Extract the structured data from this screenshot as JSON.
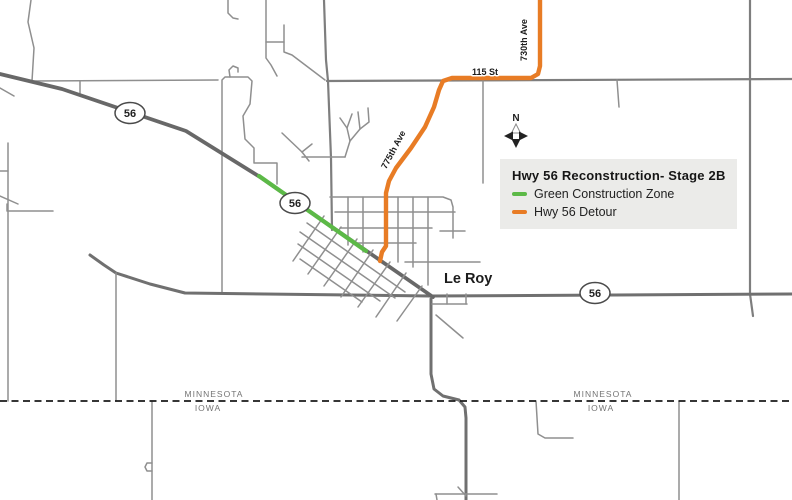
{
  "legend": {
    "title": "Hwy 56 Reconstruction- Stage 2B",
    "items": [
      {
        "label": "Green Construction Zone",
        "color": "#5cb947"
      },
      {
        "label": "Hwy 56 Detour",
        "color": "#e87c25"
      }
    ]
  },
  "map_labels": {
    "town": "Le Roy",
    "road_730": "730th Ave",
    "road_115": "115 St",
    "road_775": "775th Ave",
    "minnesota": "MINNESOTA",
    "iowa": "IOWA",
    "north": "N"
  },
  "shield": {
    "label": "56"
  },
  "colors": {
    "construction_green": "#5cb947",
    "detour_orange": "#e87c25",
    "legend_background": "#ebebe9",
    "state_border": "#1a1a1a"
  },
  "map": {
    "width": 792,
    "height": 500,
    "road_styles": {
      "minor": {
        "color": "#8f8f8f",
        "width": 1.5
      },
      "major": {
        "color": "#7e7e7e",
        "width": 2.2
      },
      "trunk": {
        "color": "#707070",
        "width": 3
      },
      "highway": {
        "color": "#686868",
        "width": 3.8
      },
      "construction": {
        "color": "#5cb947",
        "width": 4.2
      },
      "detour": {
        "color": "#e87c25",
        "width": 4.4
      },
      "border": {
        "color": "#1a1a1a",
        "width": 1.8,
        "dash": "7 4.5"
      }
    },
    "roads": [
      {
        "type": "minor",
        "pts": [
          [
            31,
            0
          ],
          [
            28,
            22
          ],
          [
            34,
            48
          ],
          [
            32,
            81
          ]
        ]
      },
      {
        "type": "minor",
        "pts": [
          [
            33,
            81
          ],
          [
            218,
            80
          ]
        ]
      },
      {
        "type": "minor",
        "pts": [
          [
            80,
            81
          ],
          [
            80,
            93
          ]
        ]
      },
      {
        "type": "minor",
        "pts": [
          [
            0,
            88
          ],
          [
            14,
            96
          ]
        ]
      },
      {
        "type": "minor",
        "pts": [
          [
            8,
            143
          ],
          [
            8,
            401
          ]
        ]
      },
      {
        "type": "minor",
        "pts": [
          [
            0,
            171
          ],
          [
            8,
            171
          ]
        ]
      },
      {
        "type": "minor",
        "pts": [
          [
            0,
            196
          ],
          [
            18,
            204
          ]
        ]
      },
      {
        "type": "minor",
        "pts": [
          [
            7,
            204
          ],
          [
            7,
            211
          ],
          [
            53,
            211
          ]
        ]
      },
      {
        "type": "minor",
        "pts": [
          [
            222,
            293
          ],
          [
            222,
            80
          ],
          [
            225,
            77
          ],
          [
            248,
            77
          ],
          [
            252,
            81
          ],
          [
            250,
            104
          ],
          [
            243,
            116
          ],
          [
            245,
            139
          ],
          [
            254,
            148
          ],
          [
            254,
            163
          ],
          [
            277,
            163
          ],
          [
            277,
            184
          ]
        ]
      },
      {
        "type": "minor",
        "pts": [
          [
            230,
            77
          ],
          [
            229,
            70
          ],
          [
            233,
            66
          ],
          [
            238,
            68
          ],
          [
            238,
            72
          ]
        ]
      },
      {
        "type": "minor",
        "pts": [
          [
            228,
            0
          ],
          [
            228,
            13
          ],
          [
            233,
            18
          ],
          [
            238,
            19
          ]
        ]
      },
      {
        "type": "minor",
        "pts": [
          [
            266,
            0
          ],
          [
            266,
            58
          ],
          [
            271,
            65
          ],
          [
            277,
            76
          ]
        ]
      },
      {
        "type": "minor",
        "pts": [
          [
            266,
            42
          ],
          [
            284,
            42
          ]
        ]
      },
      {
        "type": "minor",
        "pts": [
          [
            284,
            25
          ],
          [
            284,
            52
          ],
          [
            292,
            55
          ],
          [
            325,
            80
          ]
        ]
      },
      {
        "type": "major",
        "pts": [
          [
            324,
            0
          ],
          [
            326,
            60
          ],
          [
            328,
            81
          ],
          [
            331,
            158
          ],
          [
            332,
            230
          ]
        ]
      },
      {
        "type": "major",
        "pts": [
          [
            327,
            81
          ],
          [
            792,
            79
          ]
        ]
      },
      {
        "type": "minor",
        "pts": [
          [
            617,
            80
          ],
          [
            619,
            107
          ]
        ]
      },
      {
        "type": "major",
        "pts": [
          [
            750,
            0
          ],
          [
            750,
            294
          ],
          [
            753,
            316
          ]
        ]
      },
      {
        "type": "minor",
        "pts": [
          [
            483,
            81
          ],
          [
            483,
            183
          ]
        ]
      },
      {
        "type": "minor",
        "pts": [
          [
            302,
            157
          ],
          [
            345,
            157
          ]
        ]
      },
      {
        "type": "minor",
        "pts": [
          [
            345,
            157
          ],
          [
            350,
            141
          ],
          [
            347,
            128
          ],
          [
            352,
            114
          ]
        ]
      },
      {
        "type": "minor",
        "pts": [
          [
            350,
            141
          ],
          [
            360,
            129
          ],
          [
            358,
            112
          ]
        ]
      },
      {
        "type": "minor",
        "pts": [
          [
            347,
            128
          ],
          [
            340,
            118
          ]
        ]
      },
      {
        "type": "minor",
        "pts": [
          [
            360,
            129
          ],
          [
            369,
            122
          ],
          [
            368,
            108
          ]
        ]
      },
      {
        "type": "minor",
        "pts": [
          [
            282,
            133
          ],
          [
            302,
            152
          ]
        ]
      },
      {
        "type": "minor",
        "pts": [
          [
            302,
            152
          ],
          [
            312,
            144
          ]
        ]
      },
      {
        "type": "minor",
        "pts": [
          [
            302,
            152
          ],
          [
            309,
            161
          ]
        ]
      },
      {
        "type": "trunk",
        "pts": [
          [
            90,
            255
          ],
          [
            104,
            265
          ],
          [
            116,
            273
          ],
          [
            150,
            284
          ],
          [
            185,
            293
          ],
          [
            430,
            296
          ],
          [
            792,
            294
          ]
        ]
      },
      {
        "type": "minor",
        "pts": [
          [
            116,
            273
          ],
          [
            116,
            401
          ]
        ]
      },
      {
        "type": "highway",
        "pts": [
          [
            0,
            74
          ],
          [
            62,
            89
          ],
          [
            130,
            112
          ],
          [
            186,
            131
          ],
          [
            260,
            177
          ],
          [
            433,
            297
          ]
        ]
      },
      {
        "type": "trunk",
        "pts": [
          [
            431,
            299
          ],
          [
            431,
            374
          ],
          [
            434,
            389
          ],
          [
            443,
            396
          ],
          [
            459,
            400
          ],
          [
            465,
            407
          ],
          [
            466,
            418
          ],
          [
            466,
            500
          ]
        ]
      },
      {
        "type": "minor",
        "pts": [
          [
            436,
            315
          ],
          [
            463,
            338
          ]
        ]
      },
      {
        "type": "minor",
        "pts": [
          [
            432,
            304
          ],
          [
            467,
            304
          ]
        ]
      },
      {
        "type": "minor",
        "pts": [
          [
            447,
            294
          ],
          [
            447,
            304
          ]
        ]
      },
      {
        "type": "minor",
        "pts": [
          [
            466,
            294
          ],
          [
            466,
            304
          ]
        ]
      },
      {
        "type": "minor",
        "pts": [
          [
            152,
            401
          ],
          [
            152,
            500
          ]
        ]
      },
      {
        "type": "minor",
        "pts": [
          [
            152,
            463
          ],
          [
            147,
            463
          ],
          [
            145,
            467
          ],
          [
            147,
            471
          ],
          [
            152,
            471
          ]
        ]
      },
      {
        "type": "minor",
        "pts": [
          [
            679,
            401
          ],
          [
            679,
            500
          ]
        ]
      },
      {
        "type": "minor",
        "pts": [
          [
            536,
            401
          ],
          [
            538,
            434
          ],
          [
            545,
            438
          ],
          [
            573,
            438
          ]
        ]
      },
      {
        "type": "minor",
        "pts": [
          [
            435,
            494
          ],
          [
            497,
            494
          ]
        ]
      },
      {
        "type": "minor",
        "pts": [
          [
            436,
            494
          ],
          [
            437,
            500
          ]
        ]
      },
      {
        "type": "minor",
        "pts": [
          [
            458,
            487
          ],
          [
            466,
            496
          ]
        ]
      },
      {
        "type": "minor",
        "pts": [
          [
            330,
            197
          ],
          [
            443,
            197
          ],
          [
            451,
            200
          ],
          [
            453,
            207
          ],
          [
            453,
            238
          ]
        ]
      },
      {
        "type": "minor",
        "pts": [
          [
            335,
            212
          ],
          [
            455,
            212
          ]
        ]
      },
      {
        "type": "minor",
        "pts": [
          [
            340,
            228
          ],
          [
            432,
            228
          ]
        ]
      },
      {
        "type": "minor",
        "pts": [
          [
            355,
            243
          ],
          [
            416,
            243
          ]
        ]
      },
      {
        "type": "minor",
        "pts": [
          [
            348,
            197
          ],
          [
            348,
            245
          ]
        ]
      },
      {
        "type": "minor",
        "pts": [
          [
            363,
            197
          ],
          [
            363,
            252
          ]
        ]
      },
      {
        "type": "minor",
        "pts": [
          [
            398,
            197
          ],
          [
            398,
            262
          ]
        ]
      },
      {
        "type": "minor",
        "pts": [
          [
            413,
            197
          ],
          [
            413,
            267
          ]
        ]
      },
      {
        "type": "minor",
        "pts": [
          [
            428,
            197
          ],
          [
            428,
            285
          ]
        ]
      },
      {
        "type": "minor",
        "pts": [
          [
            440,
            231
          ],
          [
            465,
            231
          ]
        ]
      },
      {
        "type": "minor",
        "pts": [
          [
            405,
            262
          ],
          [
            480,
            262
          ]
        ]
      },
      {
        "type": "minor",
        "pts": [
          [
            307,
            223
          ],
          [
            405,
            292
          ]
        ]
      },
      {
        "type": "minor",
        "pts": [
          [
            300,
            232
          ],
          [
            395,
            298
          ]
        ]
      },
      {
        "type": "minor",
        "pts": [
          [
            298,
            244
          ],
          [
            380,
            301
          ]
        ]
      },
      {
        "type": "minor",
        "pts": [
          [
            300,
            259
          ],
          [
            362,
            302
          ]
        ]
      },
      {
        "type": "minor",
        "pts": [
          [
            324,
            216
          ],
          [
            293,
            261
          ]
        ]
      },
      {
        "type": "minor",
        "pts": [
          [
            341,
            227
          ],
          [
            308,
            274
          ]
        ]
      },
      {
        "type": "minor",
        "pts": [
          [
            357,
            239
          ],
          [
            324,
            286
          ]
        ]
      },
      {
        "type": "minor",
        "pts": [
          [
            373,
            250
          ],
          [
            341,
            297
          ]
        ]
      },
      {
        "type": "minor",
        "pts": [
          [
            390,
            262
          ],
          [
            358,
            307
          ]
        ]
      },
      {
        "type": "minor",
        "pts": [
          [
            406,
            273
          ],
          [
            376,
            317
          ]
        ]
      },
      {
        "type": "minor",
        "pts": [
          [
            422,
            286
          ],
          [
            397,
            321
          ]
        ]
      },
      {
        "type": "construction",
        "pts": [
          [
            259,
            176
          ],
          [
            366,
            251
          ]
        ]
      },
      {
        "type": "detour",
        "pts": [
          [
            540,
            0
          ],
          [
            540,
            66
          ],
          [
            538,
            74
          ],
          [
            531,
            78
          ],
          [
            452,
            78
          ],
          [
            443,
            81
          ],
          [
            439,
            90
          ],
          [
            434,
            107
          ],
          [
            425,
            127
          ],
          [
            411,
            148
          ],
          [
            396,
            168
          ],
          [
            389,
            181
          ],
          [
            386,
            193
          ],
          [
            386,
            246
          ],
          [
            382,
            252
          ],
          [
            380,
            261
          ]
        ]
      },
      {
        "type": "border",
        "pts": [
          [
            0,
            401
          ],
          [
            792,
            401
          ]
        ]
      }
    ]
  }
}
